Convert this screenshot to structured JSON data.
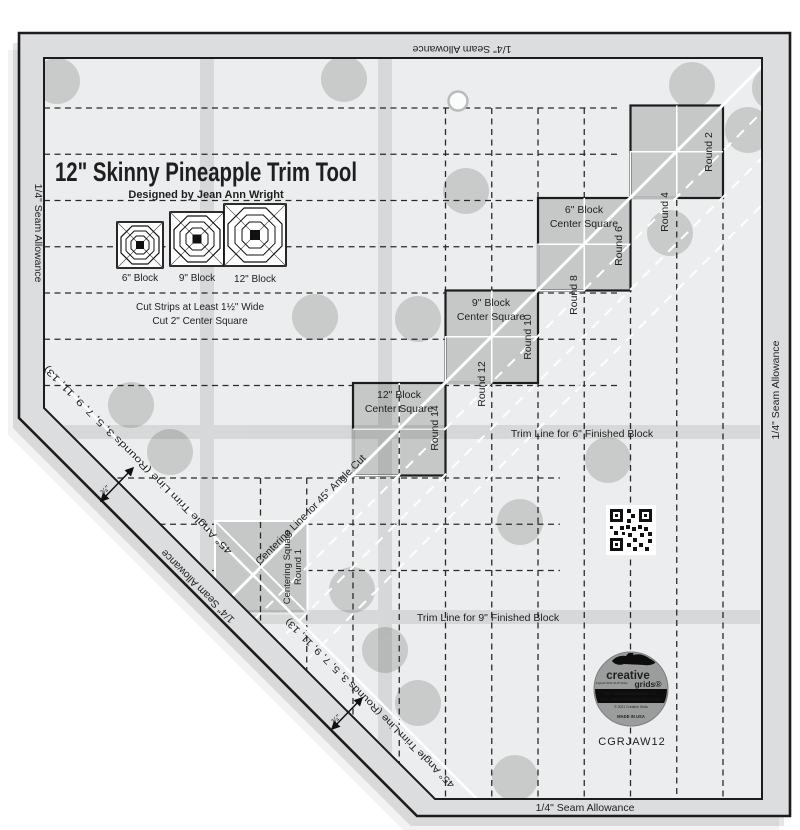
{
  "product": {
    "title": "12\" Skinny Pineapple Trim Tool",
    "designer": "Designed by Jean Ann Wright",
    "code": "CGRJAW12"
  },
  "block_icons": [
    {
      "label": "6\" Block"
    },
    {
      "label": "9\" Block"
    },
    {
      "label": "12\" Block"
    }
  ],
  "instructions": {
    "line1": "Cut Strips at Least 1½\" Wide",
    "line2": "Cut 2\" Center Square"
  },
  "center_squares": [
    {
      "line1": "6\" Block",
      "line2": "Center Square"
    },
    {
      "line1": "9\" Block",
      "line2": "Center Square"
    },
    {
      "line1": "12\" Block",
      "line2": "Center Square"
    }
  ],
  "rounds": [
    {
      "label": "Round 2"
    },
    {
      "label": "Round 4"
    },
    {
      "label": "Round 6"
    },
    {
      "label": "Round 8"
    },
    {
      "label": "Round 10"
    },
    {
      "label": "Round 12"
    },
    {
      "label": "Round 14"
    }
  ],
  "centering_square": {
    "line1": "Centering Square",
    "line2": "Round 1"
  },
  "labels": {
    "centering_line": "Centering Line for 45° Angle Cut",
    "trim_6": "Trim Line for 6\" Finished Block",
    "trim_9": "Trim Line for 9\" Finished Block",
    "angle_trim": "45° Angle Trim Line (Rounds 3, 5, 7, 9, 11, 13)",
    "angle_gap": "¾\"",
    "seam_allowance": "1/4\" Seam Allowance"
  },
  "badge": {
    "brand_top": "creative",
    "brand_bottom": "grids®",
    "tagline": "The Original NON-SLIP Ruler",
    "url_uk": "UK - www.creativegrids.com",
    "url_usa": "USA - www.creativegridsusa.com",
    "copyright": "© 2021 Creative Grids",
    "made_in": "MADE IN USA"
  },
  "colors": {
    "body": "#ecedee",
    "margin": "#dcddde",
    "square_fill": "#c6c8c8",
    "dot_fill": "#c9cbcb",
    "line_black": "#1c1c1c",
    "line_white": "#ffffff"
  }
}
